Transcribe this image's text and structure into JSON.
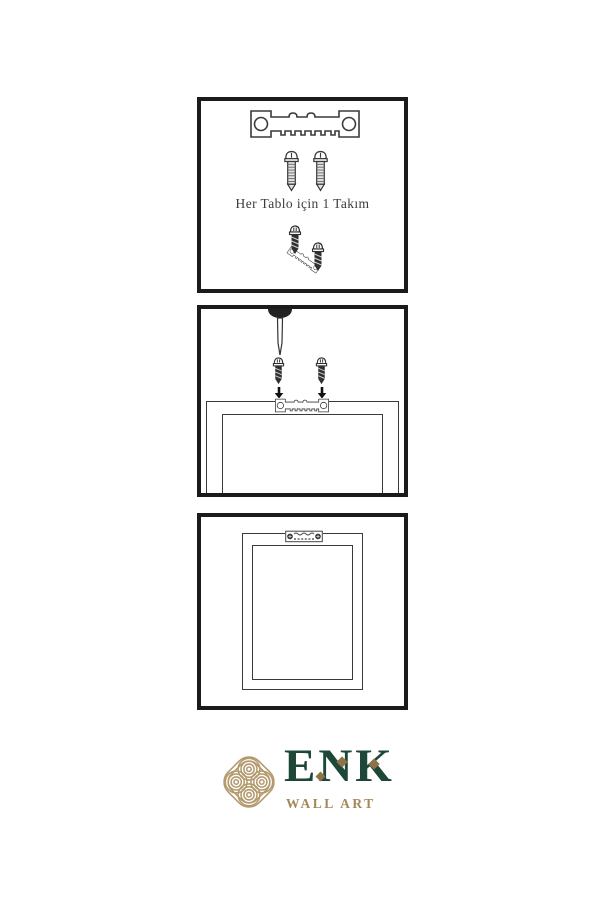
{
  "page": {
    "background": "#ffffff",
    "type": "wall-art-hanging-instructions"
  },
  "instructions": {
    "step1": {
      "caption": "Her Tablo için 1 Takım",
      "illustrations": [
        "sawtooth-hanger",
        "mounting-screw",
        "mounting-screw",
        "hanger-screw-assembly"
      ]
    },
    "step2": {
      "illustrations": [
        "awl-tool",
        "mounting-screw-with-down-arrow",
        "mounting-screw-with-down-arrow",
        "frame-back-with-sawtooth-hanger"
      ]
    },
    "step3": {
      "illustrations": [
        "frame-back-mounted-hanger"
      ]
    }
  },
  "logo": {
    "brand": "ENK",
    "subtitle": "WALL ART",
    "symbol": "celtic-knot",
    "colors": {
      "green": "#1d4736",
      "knot_gold": "#b39a6e",
      "diamond_gold": "#8f7348",
      "subtitle_gold": "#a5875a"
    }
  },
  "colors": {
    "panel_border": "#1b1b1b",
    "line_art": "#3a3a3a",
    "caption_text": "#3c3c3c",
    "screw_dark": "#2f2f2f"
  }
}
